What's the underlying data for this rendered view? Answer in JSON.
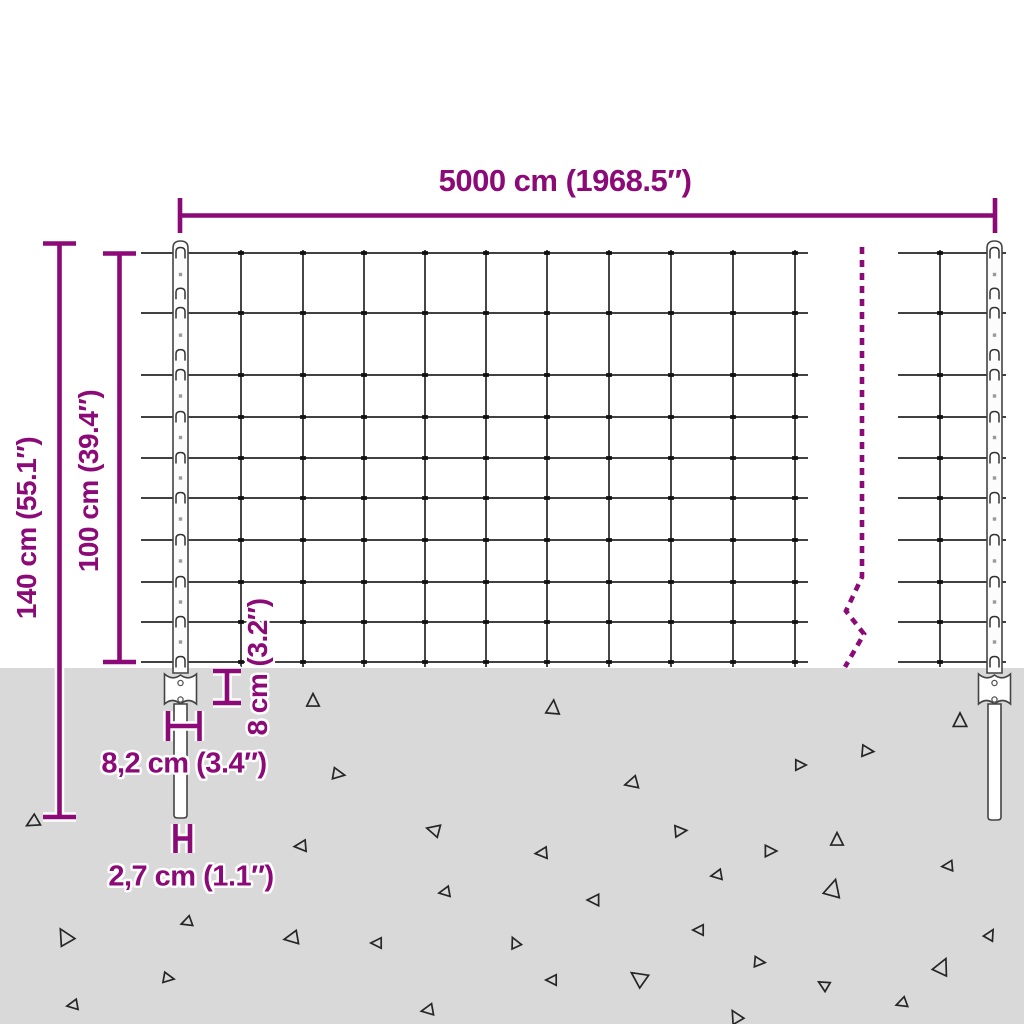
{
  "meta": {
    "title": "Wire mesh fence with anchor posts — dimension diagram"
  },
  "labels": {
    "total_width": "5000 cm (1968.5″)",
    "total_height": "140 cm (55.1″)",
    "mesh_height": "100 cm (39.4″)",
    "plate_height": "8 cm (3.2″)",
    "plate_width": "8,2 cm (3.4″)",
    "spike_width": "2,7 cm (1.1″)"
  },
  "colors": {
    "dimension_accent": "#8c0a78",
    "ground": "#d9d9d9",
    "wire": "#262626",
    "post_outline": "#444444",
    "knot": "#111111",
    "halo": "#ffffff"
  }
}
